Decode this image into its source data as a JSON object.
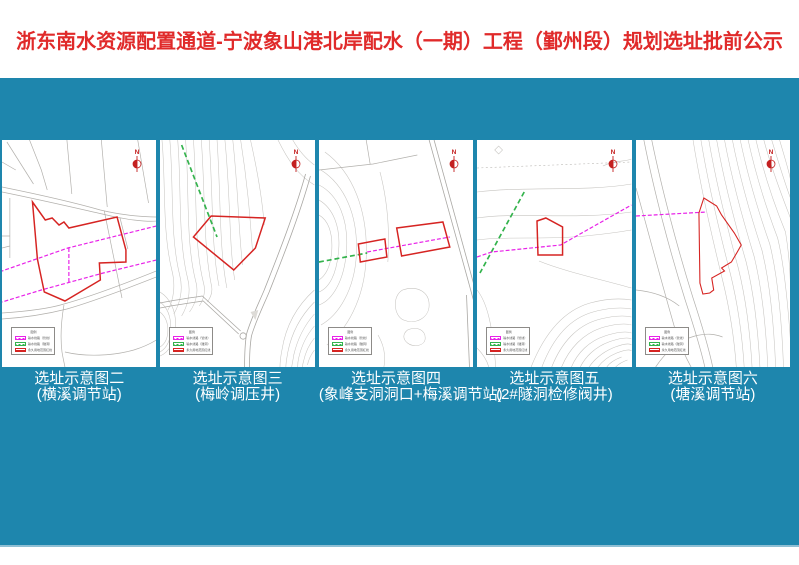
{
  "title": "浙东南水资源配置通道-宁波象山港北岸配水（一期）工程（鄞州段）规划选址批前公示",
  "colors": {
    "teal-bg": "#1E86AD",
    "title-red": "#E02A2A",
    "map-red": "#D62422",
    "map-magenta": "#E822E8",
    "map-green": "#33B34C",
    "north-red": "#C42020",
    "caption-white": "#FFFFFF"
  },
  "map": {
    "north_label": "N",
    "legend": {
      "title": "图例",
      "items": [
        {
          "label": "输水线路（管线）",
          "color": "#E822E8"
        },
        {
          "label": "输水线路（隧洞）",
          "color": "#33B34C"
        },
        {
          "label": "永久用地范围红线",
          "color": "#D62422"
        }
      ]
    }
  },
  "panels": [
    {
      "caption_line1": "选址示意图二",
      "caption_line2": "(横溪调节站)"
    },
    {
      "caption_line1": "选址示意图三",
      "caption_line2": "(梅岭调压井)"
    },
    {
      "caption_line1": "选址示意图四",
      "caption_line2": "(象峰支洞洞口+梅溪调节站)"
    },
    {
      "caption_line1": "选址示意图五",
      "caption_line2": "(2#隧洞检修阀井)"
    },
    {
      "caption_line1": "选址示意图六",
      "caption_line2": "(塘溪调节站)"
    }
  ]
}
